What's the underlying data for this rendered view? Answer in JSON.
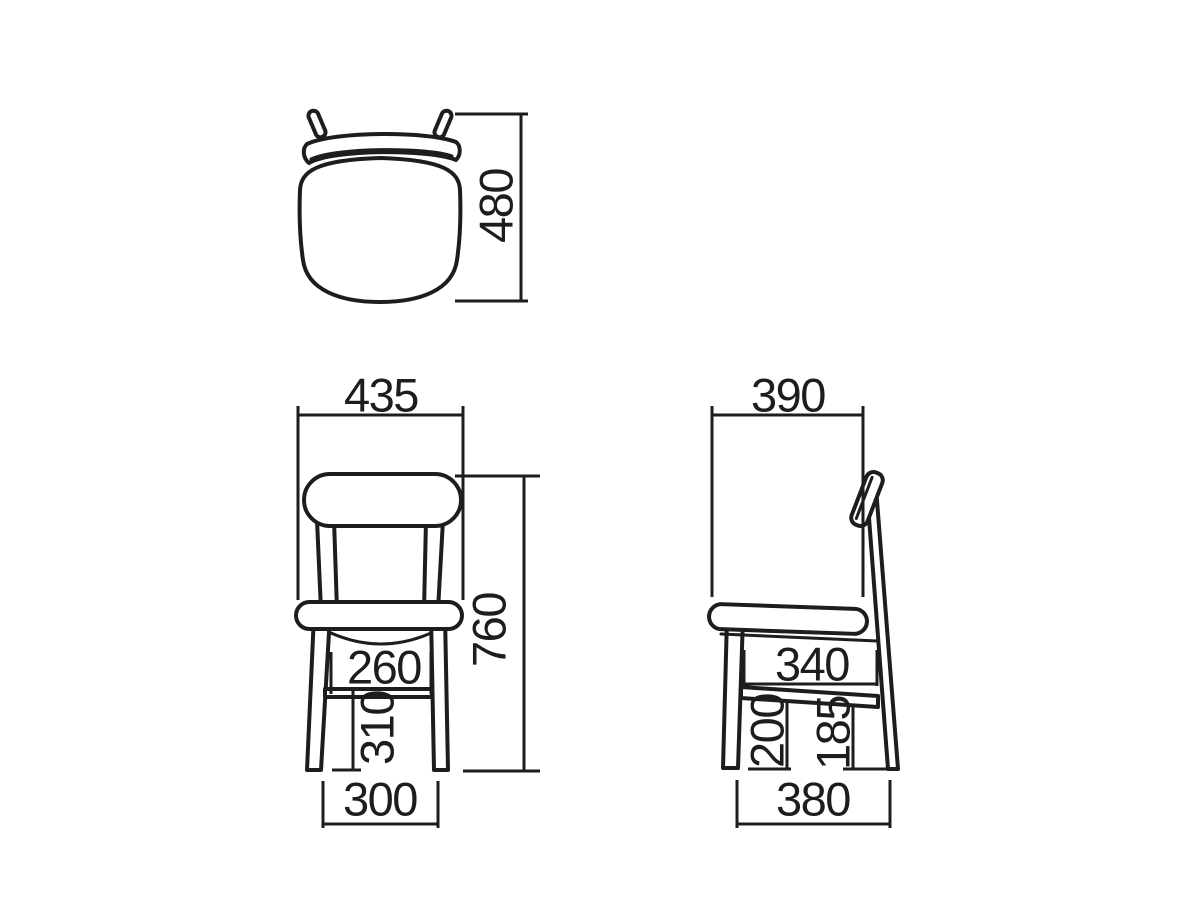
{
  "meta": {
    "drawing_type": "chair dimension diagram",
    "units": "mm",
    "background": "#ffffff",
    "line_color": "#1d1d1b"
  },
  "views": {
    "top": {
      "name": "top view",
      "dims": {
        "depth": "480"
      }
    },
    "front": {
      "name": "front view",
      "dims": {
        "seat_width": "435",
        "overall_height": "760",
        "inner_leg_width": "260",
        "stretcher_height": "310",
        "foot_width": "300"
      }
    },
    "side": {
      "name": "side view",
      "dims": {
        "seat_depth": "390",
        "frame_depth": "340",
        "front_stretcher_height": "200",
        "rear_stretcher_height": "185",
        "foot_depth": "380"
      }
    }
  }
}
